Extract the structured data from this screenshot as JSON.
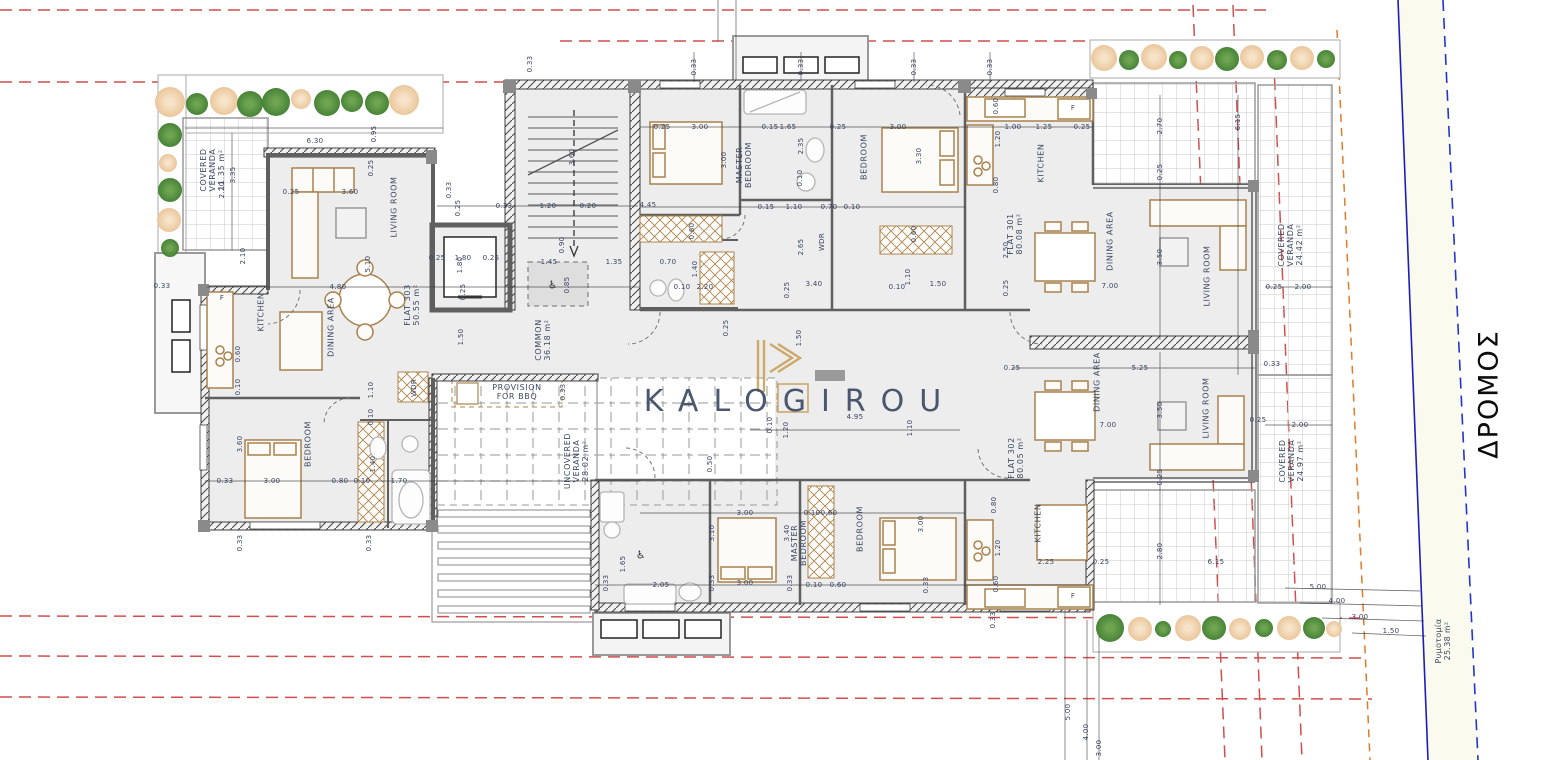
{
  "brand": {
    "logo_text": "KALOGIROU"
  },
  "road": {
    "name": "ΔΡΟΜΟΣ",
    "sidewalk_label": "Ρυμοτομία\n25.38 m²"
  },
  "units": [
    {
      "name": "FLAT 301",
      "area": "80.08 m²"
    },
    {
      "name": "FLAT 302",
      "area": "80.05 m²"
    },
    {
      "name": "FLAT 303",
      "area": "50.55 m²"
    }
  ],
  "common_areas": [
    {
      "name": "COMMON",
      "area": "36.18 m²"
    },
    {
      "name": "COVERED VERANDA",
      "area": "11.35 m²"
    },
    {
      "name": "COVERED VERANDA",
      "area": "24.42 m²"
    },
    {
      "name": "COVERED VERANDA",
      "area": "24.97 m²"
    },
    {
      "name": "UNCOVERED VERANDA",
      "area": "28.02 m²"
    },
    {
      "name": "PROVISION FOR BBQ",
      "area": ""
    },
    {
      "name": "Ρυμοτομία",
      "area": "25.38 m²"
    }
  ],
  "palette": {
    "red_dash": "#cc3b3b",
    "orange_dash": "#e07b28",
    "road_line": "#1d1dbe",
    "road_fill": "#fafaee",
    "tree_green": "#3e7d2d",
    "tree_orange": "#eac497",
    "navy_text": "#3d4a63",
    "dim_text": "#3a4464",
    "gold": "#c9a25e",
    "wall_gray": "#5f5f5f",
    "floor": "#ededed"
  },
  "labels": [
    {
      "t": "COVERED\nVERANDA\n11.35 m²",
      "x": 213,
      "y": 170,
      "r": -90,
      "c": "room"
    },
    {
      "t": "LIVING ROOM",
      "x": 394,
      "y": 207,
      "r": -90,
      "c": "room"
    },
    {
      "t": "KITCHEN",
      "x": 261,
      "y": 312,
      "r": -90,
      "c": "room"
    },
    {
      "t": "DINING AREA",
      "x": 331,
      "y": 327,
      "r": -90,
      "c": "room"
    },
    {
      "t": "FLAT 303\n50.55 m²",
      "x": 412,
      "y": 305,
      "r": -90,
      "c": "room"
    },
    {
      "t": "BEDROOM",
      "x": 308,
      "y": 444,
      "r": -90,
      "c": "room"
    },
    {
      "t": "COMMON\n36.18 m²",
      "x": 543,
      "y": 340,
      "r": -90,
      "c": "room"
    },
    {
      "t": "PROVISION\nFOR BBQ",
      "x": 517,
      "y": 392,
      "r": 0,
      "c": "room"
    },
    {
      "t": "UNCOVERED\nVERANDA\n28.02 m²",
      "x": 577,
      "y": 461,
      "r": -90,
      "c": "room"
    },
    {
      "t": "MASTER\nBEDROOM",
      "x": 744,
      "y": 165,
      "r": -90,
      "c": "room"
    },
    {
      "t": "BEDROOM",
      "x": 864,
      "y": 157,
      "r": -90,
      "c": "room"
    },
    {
      "t": "KITCHEN",
      "x": 1041,
      "y": 163,
      "r": -90,
      "c": "room"
    },
    {
      "t": "FLAT 301\n80.08 m²",
      "x": 1015,
      "y": 234,
      "r": -90,
      "c": "room"
    },
    {
      "t": "DINING AREA",
      "x": 1110,
      "y": 241,
      "r": -90,
      "c": "room"
    },
    {
      "t": "LIVING ROOM",
      "x": 1207,
      "y": 276,
      "r": -90,
      "c": "room"
    },
    {
      "t": "COVERED\nVERANDA\n24.42 m²",
      "x": 1291,
      "y": 245,
      "r": -90,
      "c": "room"
    },
    {
      "t": "DINING AREA",
      "x": 1097,
      "y": 382,
      "r": -90,
      "c": "room"
    },
    {
      "t": "FLAT 302\n80.05 m²",
      "x": 1016,
      "y": 458,
      "r": -90,
      "c": "room"
    },
    {
      "t": "LIVING ROOM",
      "x": 1206,
      "y": 408,
      "r": -90,
      "c": "room"
    },
    {
      "t": "COVERED\nVERANDA\n24.97 m²",
      "x": 1292,
      "y": 461,
      "r": -90,
      "c": "room"
    },
    {
      "t": "KITCHEN",
      "x": 1038,
      "y": 523,
      "r": -90,
      "c": "room"
    },
    {
      "t": "MASTER\nBEDROOM",
      "x": 799,
      "y": 543,
      "r": -90,
      "c": "room"
    },
    {
      "t": "BEDROOM",
      "x": 860,
      "y": 529,
      "r": -90,
      "c": "room"
    },
    {
      "t": "WDR",
      "x": 414,
      "y": 388,
      "r": -90
    },
    {
      "t": "WDR",
      "x": 822,
      "y": 242,
      "r": -90
    },
    {
      "t": "♿",
      "x": 553,
      "y": 286,
      "r": 0,
      "c": "wc"
    },
    {
      "t": "♿",
      "x": 641,
      "y": 556,
      "r": 0,
      "c": "wc"
    },
    {
      "t": "F",
      "x": 222,
      "y": 298,
      "r": 0
    },
    {
      "t": "F",
      "x": 1073,
      "y": 108,
      "r": 0
    },
    {
      "t": "F",
      "x": 1073,
      "y": 596,
      "r": 0
    },
    {
      "t": "6.30",
      "x": 315,
      "y": 141,
      "r": 0
    },
    {
      "t": "0.95",
      "x": 374,
      "y": 134,
      "r": -90
    },
    {
      "t": "2.20",
      "x": 222,
      "y": 190,
      "r": -90
    },
    {
      "t": "3.35",
      "x": 233,
      "y": 175,
      "r": -90
    },
    {
      "t": "0.25",
      "x": 371,
      "y": 168,
      "r": -90
    },
    {
      "t": "3.60",
      "x": 350,
      "y": 192,
      "r": 0
    },
    {
      "t": "0.25",
      "x": 291,
      "y": 192,
      "r": 0
    },
    {
      "t": "0.33",
      "x": 449,
      "y": 190,
      "r": -90
    },
    {
      "t": "0.25",
      "x": 458,
      "y": 208,
      "r": -90
    },
    {
      "t": "5.10",
      "x": 368,
      "y": 264,
      "r": -90
    },
    {
      "t": "4.80",
      "x": 338,
      "y": 287,
      "r": 0
    },
    {
      "t": "2.10",
      "x": 243,
      "y": 256,
      "r": -90
    },
    {
      "t": "0.33",
      "x": 162,
      "y": 286,
      "r": 0
    },
    {
      "t": "1.80",
      "x": 460,
      "y": 265,
      "r": -90
    },
    {
      "t": "0.60",
      "x": 238,
      "y": 354,
      "r": -90
    },
    {
      "t": "0.10",
      "x": 238,
      "y": 387,
      "r": -90
    },
    {
      "t": "1.10",
      "x": 371,
      "y": 390,
      "r": -90
    },
    {
      "t": "0.10",
      "x": 371,
      "y": 417,
      "r": -90
    },
    {
      "t": "3.60",
      "x": 240,
      "y": 444,
      "r": -90
    },
    {
      "t": "3.00",
      "x": 272,
      "y": 481,
      "r": 0
    },
    {
      "t": "0.33",
      "x": 225,
      "y": 481,
      "r": 0
    },
    {
      "t": "1.40",
      "x": 373,
      "y": 464,
      "r": -90
    },
    {
      "t": "0.80",
      "x": 340,
      "y": 481,
      "r": 0
    },
    {
      "t": "0.10",
      "x": 362,
      "y": 481,
      "r": 0
    },
    {
      "t": "1.70",
      "x": 399,
      "y": 481,
      "r": 0
    },
    {
      "t": "0.33",
      "x": 240,
      "y": 543,
      "r": -90
    },
    {
      "t": "0.33",
      "x": 369,
      "y": 543,
      "r": -90
    },
    {
      "t": "1.50",
      "x": 461,
      "y": 337,
      "r": -90
    },
    {
      "t": "0.33",
      "x": 530,
      "y": 64,
      "r": -90
    },
    {
      "t": "0.33",
      "x": 504,
      "y": 206,
      "r": 0
    },
    {
      "t": "1.20",
      "x": 548,
      "y": 206,
      "r": 0
    },
    {
      "t": "0.20",
      "x": 588,
      "y": 206,
      "r": 0
    },
    {
      "t": "3.60",
      "x": 572,
      "y": 157,
      "r": -90
    },
    {
      "t": "0.90",
      "x": 562,
      "y": 245,
      "r": -90
    },
    {
      "t": "1.45",
      "x": 549,
      "y": 262,
      "r": 0
    },
    {
      "t": "0.85",
      "x": 567,
      "y": 285,
      "r": -90
    },
    {
      "t": "1.35",
      "x": 614,
      "y": 262,
      "r": 0
    },
    {
      "t": "0.25",
      "x": 437,
      "y": 258,
      "r": 0
    },
    {
      "t": "1.80",
      "x": 463,
      "y": 258,
      "r": 0
    },
    {
      "t": "0.25",
      "x": 491,
      "y": 258,
      "r": 0
    },
    {
      "t": "0.25",
      "x": 463,
      "y": 292,
      "r": -90
    },
    {
      "t": "0.33",
      "x": 694,
      "y": 67,
      "r": -90
    },
    {
      "t": "0.33",
      "x": 801,
      "y": 67,
      "r": -90
    },
    {
      "t": "0.33",
      "x": 914,
      "y": 67,
      "r": -90
    },
    {
      "t": "0.33",
      "x": 990,
      "y": 67,
      "r": -90
    },
    {
      "t": "0.25",
      "x": 662,
      "y": 127,
      "r": 0
    },
    {
      "t": "3.00",
      "x": 700,
      "y": 127,
      "r": 0
    },
    {
      "t": "3.00",
      "x": 724,
      "y": 160,
      "r": -90
    },
    {
      "t": "4.45",
      "x": 648,
      "y": 205,
      "r": 0
    },
    {
      "t": "0.60",
      "x": 692,
      "y": 231,
      "r": -90
    },
    {
      "t": "1.40",
      "x": 695,
      "y": 269,
      "r": -90
    },
    {
      "t": "2.20",
      "x": 705,
      "y": 287,
      "r": 0
    },
    {
      "t": "0.10",
      "x": 682,
      "y": 287,
      "r": 0
    },
    {
      "t": "0.70",
      "x": 668,
      "y": 262,
      "r": 0
    },
    {
      "t": "0.15",
      "x": 770,
      "y": 127,
      "r": 0
    },
    {
      "t": "1.65",
      "x": 788,
      "y": 127,
      "r": 0
    },
    {
      "t": "2.35",
      "x": 801,
      "y": 146,
      "r": -90
    },
    {
      "t": "0.25",
      "x": 838,
      "y": 127,
      "r": 0
    },
    {
      "t": "3.00",
      "x": 898,
      "y": 127,
      "r": 0
    },
    {
      "t": "3.30",
      "x": 919,
      "y": 156,
      "r": -90
    },
    {
      "t": "0.10",
      "x": 800,
      "y": 178,
      "r": -90
    },
    {
      "t": "1.10",
      "x": 794,
      "y": 207,
      "r": 0
    },
    {
      "t": "0.15",
      "x": 766,
      "y": 207,
      "r": 0
    },
    {
      "t": "0.70",
      "x": 829,
      "y": 207,
      "r": 0
    },
    {
      "t": "0.10",
      "x": 852,
      "y": 207,
      "r": 0
    },
    {
      "t": "2.65",
      "x": 801,
      "y": 247,
      "r": -90
    },
    {
      "t": "3.40",
      "x": 814,
      "y": 284,
      "r": 0
    },
    {
      "t": "0.25",
      "x": 787,
      "y": 290,
      "r": -90
    },
    {
      "t": "1.50",
      "x": 938,
      "y": 284,
      "r": 0
    },
    {
      "t": "1.10",
      "x": 908,
      "y": 277,
      "r": -90
    },
    {
      "t": "0.10",
      "x": 897,
      "y": 287,
      "r": 0
    },
    {
      "t": "0.60",
      "x": 914,
      "y": 234,
      "r": -90
    },
    {
      "t": "1.00",
      "x": 1013,
      "y": 127,
      "r": 0
    },
    {
      "t": "1.25",
      "x": 1044,
      "y": 127,
      "r": 0
    },
    {
      "t": "0.25",
      "x": 1082,
      "y": 127,
      "r": 0
    },
    {
      "t": "0.60",
      "x": 996,
      "y": 106,
      "r": -90
    },
    {
      "t": "1.20",
      "x": 998,
      "y": 139,
      "r": -90
    },
    {
      "t": "0.80",
      "x": 996,
      "y": 185,
      "r": -90
    },
    {
      "t": "2.50",
      "x": 1006,
      "y": 250,
      "r": -90
    },
    {
      "t": "0.25",
      "x": 1006,
      "y": 288,
      "r": -90
    },
    {
      "t": "2.70",
      "x": 1160,
      "y": 126,
      "r": -90
    },
    {
      "t": "6.15",
      "x": 1238,
      "y": 122,
      "r": -90
    },
    {
      "t": "0.25",
      "x": 1160,
      "y": 172,
      "r": -90
    },
    {
      "t": "3.50",
      "x": 1160,
      "y": 257,
      "r": -90
    },
    {
      "t": "7.00",
      "x": 1110,
      "y": 286,
      "r": 0
    },
    {
      "t": "0.25",
      "x": 1274,
      "y": 287,
      "r": 0
    },
    {
      "t": "2.00",
      "x": 1303,
      "y": 287,
      "r": 0
    },
    {
      "t": "0.33",
      "x": 1272,
      "y": 364,
      "r": 0
    },
    {
      "t": "0.25",
      "x": 1258,
      "y": 420,
      "r": 0
    },
    {
      "t": "2.00",
      "x": 1300,
      "y": 425,
      "r": 0
    },
    {
      "t": "0.25",
      "x": 726,
      "y": 328,
      "r": -90
    },
    {
      "t": "1.50",
      "x": 799,
      "y": 338,
      "r": -90
    },
    {
      "t": "4.95",
      "x": 855,
      "y": 417,
      "r": 0
    },
    {
      "t": "1.10",
      "x": 910,
      "y": 428,
      "r": -90
    },
    {
      "t": "1.20",
      "x": 786,
      "y": 430,
      "r": -90
    },
    {
      "t": "0.10",
      "x": 770,
      "y": 425,
      "r": -90
    },
    {
      "t": "0.50",
      "x": 710,
      "y": 464,
      "r": -90
    },
    {
      "t": "0.33",
      "x": 563,
      "y": 392,
      "r": -90
    },
    {
      "t": "3.10",
      "x": 712,
      "y": 533,
      "r": -90
    },
    {
      "t": "0.25",
      "x": 1012,
      "y": 368,
      "r": 0
    },
    {
      "t": "5.25",
      "x": 1140,
      "y": 368,
      "r": 0
    },
    {
      "t": "3.50",
      "x": 1160,
      "y": 410,
      "r": -90
    },
    {
      "t": "7.00",
      "x": 1108,
      "y": 425,
      "r": 0
    },
    {
      "t": "0.25",
      "x": 1160,
      "y": 477,
      "r": -90
    },
    {
      "t": "2.25",
      "x": 1046,
      "y": 562,
      "r": 0
    },
    {
      "t": "0.25",
      "x": 1101,
      "y": 562,
      "r": 0
    },
    {
      "t": "2.80",
      "x": 1160,
      "y": 551,
      "r": -90
    },
    {
      "t": "6.15",
      "x": 1216,
      "y": 562,
      "r": 0
    },
    {
      "t": "5.00",
      "x": 1318,
      "y": 587,
      "r": 0
    },
    {
      "t": "0.80",
      "x": 994,
      "y": 505,
      "r": -90
    },
    {
      "t": "1.20",
      "x": 998,
      "y": 548,
      "r": -90
    },
    {
      "t": "0.60",
      "x": 996,
      "y": 584,
      "r": -90
    },
    {
      "t": "0.33",
      "x": 993,
      "y": 620,
      "r": -90
    },
    {
      "t": "3.40",
      "x": 787,
      "y": 533,
      "r": -90
    },
    {
      "t": "3.00",
      "x": 745,
      "y": 513,
      "r": 0
    },
    {
      "t": "0.60",
      "x": 829,
      "y": 513,
      "r": 0
    },
    {
      "t": "0.10",
      "x": 812,
      "y": 513,
      "r": 0
    },
    {
      "t": "3.00",
      "x": 921,
      "y": 524,
      "r": -90
    },
    {
      "t": "3.00",
      "x": 745,
      "y": 583,
      "r": 0
    },
    {
      "t": "0.33",
      "x": 712,
      "y": 583,
      "r": -90
    },
    {
      "t": "0.33",
      "x": 790,
      "y": 583,
      "r": -90
    },
    {
      "t": "2.05",
      "x": 661,
      "y": 585,
      "r": 0
    },
    {
      "t": "1.65",
      "x": 623,
      "y": 564,
      "r": -90
    },
    {
      "t": "0.33",
      "x": 606,
      "y": 583,
      "r": -90
    },
    {
      "t": "0.10",
      "x": 814,
      "y": 585,
      "r": 0
    },
    {
      "t": "0.60",
      "x": 838,
      "y": 585,
      "r": 0
    },
    {
      "t": "0.33",
      "x": 926,
      "y": 585,
      "r": -90
    },
    {
      "t": "5.00",
      "x": 1068,
      "y": 712,
      "r": -90
    },
    {
      "t": "4.00",
      "x": 1086,
      "y": 732,
      "r": -90
    },
    {
      "t": "3.00",
      "x": 1099,
      "y": 748,
      "r": -90
    },
    {
      "t": "4.00",
      "x": 1337,
      "y": 601,
      "r": 0
    },
    {
      "t": "3.00",
      "x": 1360,
      "y": 617,
      "r": 0
    },
    {
      "t": "1.50",
      "x": 1391,
      "y": 631,
      "r": 0
    }
  ],
  "trees": [
    {
      "x": 170,
      "y": 102,
      "rr": 15,
      "c": "orange"
    },
    {
      "x": 197,
      "y": 104,
      "rr": 11,
      "c": "green"
    },
    {
      "x": 224,
      "y": 101,
      "rr": 14,
      "c": "orange"
    },
    {
      "x": 250,
      "y": 104,
      "rr": 13,
      "c": "green"
    },
    {
      "x": 276,
      "y": 102,
      "rr": 14,
      "c": "green"
    },
    {
      "x": 301,
      "y": 99,
      "rr": 10,
      "c": "orange"
    },
    {
      "x": 327,
      "y": 103,
      "rr": 13,
      "c": "green"
    },
    {
      "x": 352,
      "y": 101,
      "rr": 11,
      "c": "green"
    },
    {
      "x": 377,
      "y": 103,
      "rr": 12,
      "c": "green"
    },
    {
      "x": 404,
      "y": 100,
      "rr": 15,
      "c": "orange"
    },
    {
      "x": 170,
      "y": 135,
      "rr": 12,
      "c": "green"
    },
    {
      "x": 168,
      "y": 163,
      "rr": 9,
      "c": "orange"
    },
    {
      "x": 170,
      "y": 190,
      "rr": 12,
      "c": "green"
    },
    {
      "x": 169,
      "y": 220,
      "rr": 12,
      "c": "orange"
    },
    {
      "x": 170,
      "y": 248,
      "rr": 9,
      "c": "green"
    },
    {
      "x": 1104,
      "y": 58,
      "rr": 13,
      "c": "orange"
    },
    {
      "x": 1129,
      "y": 60,
      "rr": 10,
      "c": "green"
    },
    {
      "x": 1154,
      "y": 57,
      "rr": 13,
      "c": "orange"
    },
    {
      "x": 1178,
      "y": 60,
      "rr": 9,
      "c": "green"
    },
    {
      "x": 1202,
      "y": 58,
      "rr": 12,
      "c": "orange"
    },
    {
      "x": 1227,
      "y": 59,
      "rr": 12,
      "c": "green"
    },
    {
      "x": 1252,
      "y": 57,
      "rr": 12,
      "c": "orange"
    },
    {
      "x": 1277,
      "y": 60,
      "rr": 10,
      "c": "green"
    },
    {
      "x": 1302,
      "y": 58,
      "rr": 12,
      "c": "orange"
    },
    {
      "x": 1326,
      "y": 59,
      "rr": 9,
      "c": "green"
    },
    {
      "x": 1110,
      "y": 628,
      "rr": 14,
      "c": "green"
    },
    {
      "x": 1140,
      "y": 629,
      "rr": 12,
      "c": "orange"
    },
    {
      "x": 1163,
      "y": 629,
      "rr": 8,
      "c": "green"
    },
    {
      "x": 1188,
      "y": 628,
      "rr": 13,
      "c": "orange"
    },
    {
      "x": 1214,
      "y": 628,
      "rr": 12,
      "c": "green"
    },
    {
      "x": 1240,
      "y": 629,
      "rr": 11,
      "c": "orange"
    },
    {
      "x": 1264,
      "y": 628,
      "rr": 9,
      "c": "green"
    },
    {
      "x": 1289,
      "y": 628,
      "rr": 12,
      "c": "orange"
    },
    {
      "x": 1314,
      "y": 628,
      "rr": 11,
      "c": "green"
    },
    {
      "x": 1334,
      "y": 629,
      "rr": 8,
      "c": "orange"
    }
  ]
}
